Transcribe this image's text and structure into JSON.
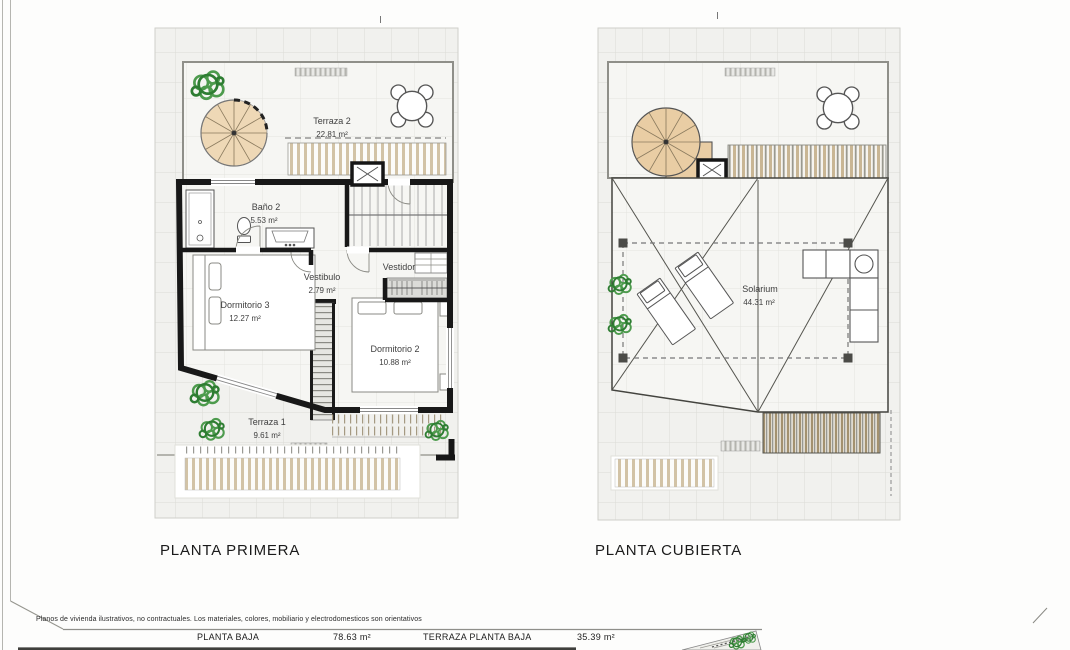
{
  "document": {
    "type": "architectural floor plan sheet",
    "sheet_background": "#fdfdfc"
  },
  "plans": [
    {
      "id": "planta-primera",
      "title": "PLANTA PRIMERA",
      "rooms": [
        {
          "name": "Terraza 2",
          "area": "22.81 m²"
        },
        {
          "name": "Baño 2",
          "area": "5.53 m²"
        },
        {
          "name": "Vestibulo",
          "area": "2.79 m²"
        },
        {
          "name": "Vestidor",
          "area": ""
        },
        {
          "name": "Dormitorio 3",
          "area": "12.27 m²"
        },
        {
          "name": "Dormitorio 2",
          "area": "10.88 m²"
        },
        {
          "name": "Terraza 1",
          "area": "9.61 m²"
        }
      ],
      "symbols": [
        "spiral-staircase",
        "dining-table-with-chairs",
        "plant",
        "pergola-slats",
        "lift-shaft",
        "staircase",
        "shower",
        "toilet",
        "washbasin",
        "double-bed",
        "wardrobe",
        "closet"
      ]
    },
    {
      "id": "planta-cubierta",
      "title": "PLANTA CUBIERTA",
      "rooms": [
        {
          "name": "Solarium",
          "area": "44.31 m²"
        }
      ],
      "symbols": [
        "spiral-staircase",
        "dining-table-with-chairs",
        "plant",
        "pergola-slats",
        "lift-shaft",
        "sun-lounger",
        "corner-sofa",
        "roof-drain-lines",
        "posts"
      ]
    }
  ],
  "footer": {
    "disclaimer": "Planos de vivienda ilustrativos, no contractuales. Los materiales, colores, mobiliario y electrodomesticos son orientativos",
    "measurements": [
      {
        "label": "PLANTA BAJA",
        "value": "78.63 m²"
      },
      {
        "label": "TERRAZA PLANTA BAJA",
        "value": "35.39 m²"
      }
    ]
  },
  "colors": {
    "wall": "#181818",
    "wood_fill": "#e9cda4",
    "slat_tan": "#d2c3a6",
    "plant_green": "#4d9b4d",
    "tile_line": "#dcdcd6",
    "thin_line": "#8f8f89"
  }
}
